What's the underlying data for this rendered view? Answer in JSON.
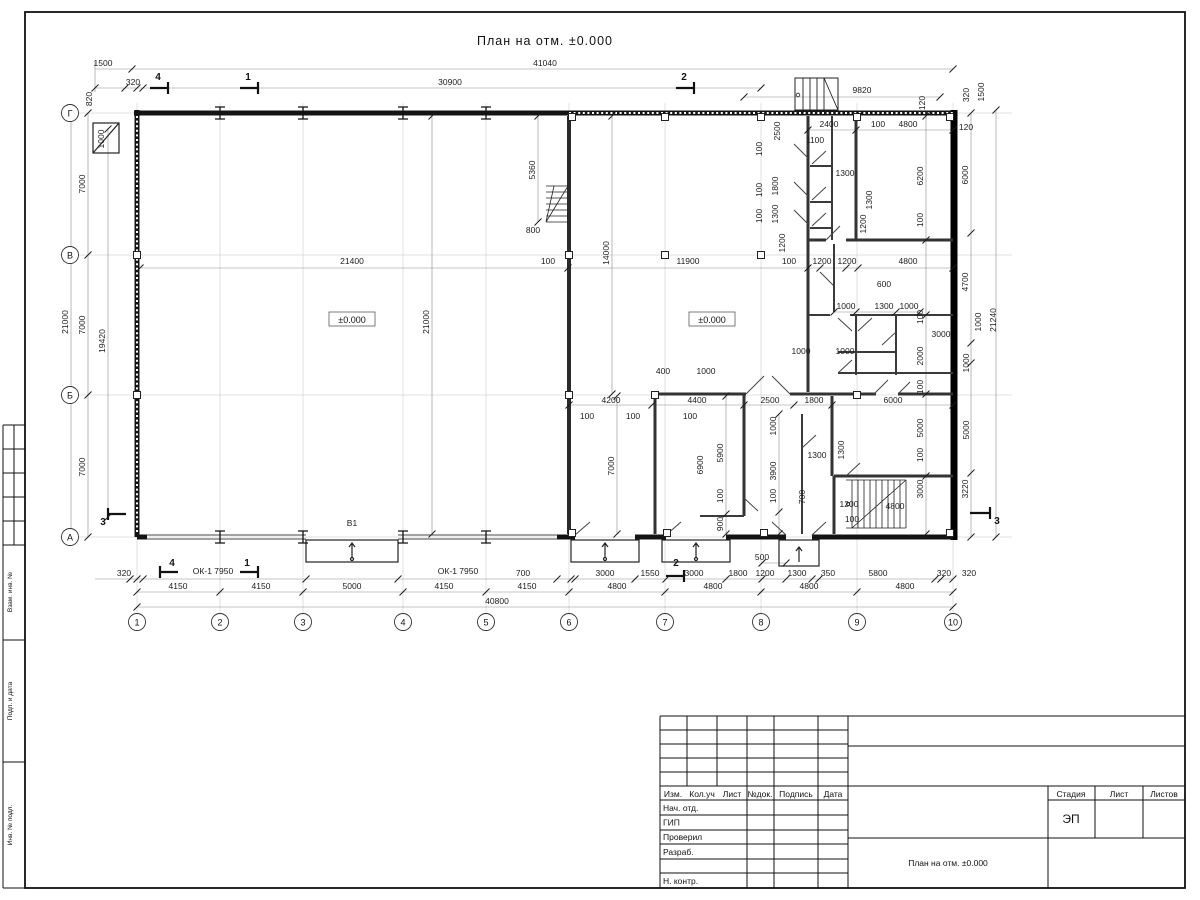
{
  "sheet": {
    "title": "План на отм. ±0.000"
  },
  "axes": {
    "cols": [
      {
        "n": "1",
        "x": 137
      },
      {
        "n": "2",
        "x": 220
      },
      {
        "n": "3",
        "x": 303
      },
      {
        "n": "4",
        "x": 403
      },
      {
        "n": "5",
        "x": 486
      },
      {
        "n": "6",
        "x": 569
      },
      {
        "n": "7",
        "x": 665
      },
      {
        "n": "8",
        "x": 761
      },
      {
        "n": "9",
        "x": 857
      },
      {
        "n": "10",
        "x": 953
      }
    ],
    "rows": [
      {
        "n": "Г",
        "y": 113
      },
      {
        "n": "В",
        "y": 255
      },
      {
        "n": "Б",
        "y": 395
      },
      {
        "n": "А",
        "y": 537
      }
    ]
  },
  "levels": [
    {
      "t": "±0.000",
      "x": 352,
      "y": 322
    },
    {
      "t": "±0.000",
      "x": 712,
      "y": 322
    }
  ],
  "labels": [
    [
      "1500",
      103,
      66,
      0
    ],
    [
      "41040",
      545,
      66,
      0
    ],
    [
      "320",
      133,
      85,
      0
    ],
    [
      "30900",
      450,
      85,
      0
    ],
    [
      "9820",
      862,
      93,
      0
    ],
    [
      "820",
      92,
      99,
      1
    ],
    [
      "1000",
      104,
      139,
      1
    ],
    [
      "120",
      925,
      103,
      1
    ],
    [
      "320",
      969,
      95,
      1
    ],
    [
      "1500",
      984,
      92,
      1
    ],
    [
      "120",
      966,
      130,
      0
    ],
    [
      "7000",
      85,
      184,
      1
    ],
    [
      "21000",
      68,
      322,
      1
    ],
    [
      "7000",
      85,
      325,
      1
    ],
    [
      "19420",
      105,
      341,
      1
    ],
    [
      "7000",
      85,
      467,
      1
    ],
    [
      "6000",
      968,
      175,
      1
    ],
    [
      "4700",
      968,
      282,
      1
    ],
    [
      "21240",
      996,
      320,
      1
    ],
    [
      "1000",
      981,
      322,
      1
    ],
    [
      "1000",
      969,
      363,
      1
    ],
    [
      "5000",
      969,
      430,
      1
    ],
    [
      "3220",
      968,
      489,
      1
    ],
    [
      "320",
      969,
      576,
      0
    ],
    [
      "320",
      124,
      576,
      0
    ],
    [
      "ОК-1 7950",
      213,
      574,
      0
    ],
    [
      "ОК-1 7950",
      458,
      574,
      0
    ],
    [
      "700",
      523,
      576,
      0
    ],
    [
      "3000",
      605,
      576,
      0
    ],
    [
      "1550",
      650,
      576,
      0
    ],
    [
      "3000",
      694,
      576,
      0
    ],
    [
      "1800",
      738,
      576,
      0
    ],
    [
      "1200",
      765,
      576,
      0
    ],
    [
      "500",
      762,
      560,
      0
    ],
    [
      "1300",
      797,
      576,
      0
    ],
    [
      "350",
      828,
      576,
      0
    ],
    [
      "5800",
      878,
      576,
      0
    ],
    [
      "320",
      944,
      576,
      0
    ],
    [
      "4150",
      178,
      589,
      0
    ],
    [
      "4150",
      261,
      589,
      0
    ],
    [
      "5000",
      352,
      589,
      0
    ],
    [
      "4150",
      444,
      589,
      0
    ],
    [
      "4150",
      527,
      589,
      0
    ],
    [
      "4800",
      617,
      589,
      0
    ],
    [
      "4800",
      713,
      589,
      0
    ],
    [
      "4800",
      809,
      589,
      0
    ],
    [
      "4800",
      905,
      589,
      0
    ],
    [
      "40800",
      497,
      604,
      0
    ],
    [
      "21400",
      352,
      264,
      0
    ],
    [
      "100",
      548,
      264,
      0
    ],
    [
      "21000",
      429,
      322,
      1
    ],
    [
      "14000",
      609,
      253,
      1
    ],
    [
      "5360",
      535,
      170,
      1
    ],
    [
      "800",
      533,
      233,
      0
    ],
    [
      "11900",
      688,
      264,
      0
    ],
    [
      "100",
      789,
      264,
      0
    ],
    [
      "В1",
      352,
      526,
      0
    ],
    [
      "1200",
      822,
      264,
      0
    ],
    [
      "1200",
      847,
      264,
      0
    ],
    [
      "4800",
      908,
      264,
      0
    ],
    [
      "2400",
      829,
      127,
      0
    ],
    [
      "100",
      878,
      127,
      0
    ],
    [
      "4800",
      908,
      127,
      0
    ],
    [
      "1100",
      815,
      143,
      0
    ],
    [
      "2500",
      780,
      131,
      1
    ],
    [
      "100",
      762,
      149,
      1
    ],
    [
      "1800",
      778,
      186,
      1
    ],
    [
      "100",
      762,
      190,
      1
    ],
    [
      "1300",
      778,
      214,
      1
    ],
    [
      "100",
      762,
      216,
      1
    ],
    [
      "1300",
      845,
      176,
      0
    ],
    [
      "6200",
      923,
      176,
      1
    ],
    [
      "1300",
      872,
      200,
      1
    ],
    [
      "1200",
      866,
      224,
      1
    ],
    [
      "100",
      923,
      220,
      1
    ],
    [
      "1200",
      785,
      243,
      1
    ],
    [
      "600",
      884,
      287,
      0
    ],
    [
      "1000",
      846,
      309,
      0
    ],
    [
      "1300",
      884,
      309,
      0
    ],
    [
      "1000",
      909,
      309,
      0
    ],
    [
      "100",
      923,
      317,
      1
    ],
    [
      "3000",
      941,
      337,
      0
    ],
    [
      "1000",
      845,
      354,
      0
    ],
    [
      "1000",
      801,
      354,
      0
    ],
    [
      "2000",
      923,
      356,
      1
    ],
    [
      "100",
      923,
      387,
      1
    ],
    [
      "400",
      663,
      374,
      0
    ],
    [
      "1000",
      706,
      374,
      0
    ],
    [
      "4200",
      611,
      403,
      0
    ],
    [
      "100",
      587,
      419,
      0
    ],
    [
      "4400",
      697,
      403,
      0
    ],
    [
      "100",
      633,
      419,
      0
    ],
    [
      "2500",
      770,
      403,
      0
    ],
    [
      "100",
      690,
      419,
      0
    ],
    [
      "1800",
      814,
      403,
      0
    ],
    [
      "6000",
      893,
      403,
      0
    ],
    [
      "7000",
      614,
      466,
      1
    ],
    [
      "6900",
      703,
      465,
      1
    ],
    [
      "5900",
      723,
      453,
      1
    ],
    [
      "100",
      723,
      496,
      1
    ],
    [
      "900",
      723,
      524,
      1
    ],
    [
      "1000",
      776,
      426,
      1
    ],
    [
      "3900",
      776,
      471,
      1
    ],
    [
      "100",
      776,
      496,
      1
    ],
    [
      "1300",
      817,
      458,
      0
    ],
    [
      "1300",
      844,
      450,
      1
    ],
    [
      "700",
      805,
      497,
      1
    ],
    [
      "1200",
      849,
      507,
      0
    ],
    [
      "100",
      852,
      522,
      0
    ],
    [
      "4800",
      895,
      509,
      0
    ],
    [
      "3000",
      923,
      489,
      1
    ],
    [
      "5000",
      923,
      428,
      1
    ],
    [
      "100",
      923,
      455,
      1
    ],
    [
      "4",
      158,
      80,
      0
    ],
    [
      "1",
      248,
      80,
      0
    ],
    [
      "2",
      684,
      80,
      0
    ],
    [
      "4",
      172,
      566,
      0
    ],
    [
      "1",
      247,
      566,
      0
    ],
    [
      "2",
      676,
      566,
      0
    ],
    [
      "3",
      103,
      525,
      0
    ],
    [
      "3",
      997,
      524,
      0
    ]
  ],
  "title_block": {
    "rev_headers": [
      "Изм.",
      "Кол.уч",
      "Лист",
      "№док.",
      "Подпись",
      "Дата"
    ],
    "sign_rows": [
      "Нач. отд.",
      "ГИП",
      "Проверил",
      "Разраб.",
      "",
      "Н. контр."
    ],
    "stage_headers": [
      "Стадия",
      "Лист",
      "Листов"
    ],
    "stage": "ЭП",
    "doc_title": "План на отм. ±0.000"
  },
  "side_strip": [
    "Взам. инв. №",
    "Подп. и дата",
    "Инв. № подл."
  ]
}
